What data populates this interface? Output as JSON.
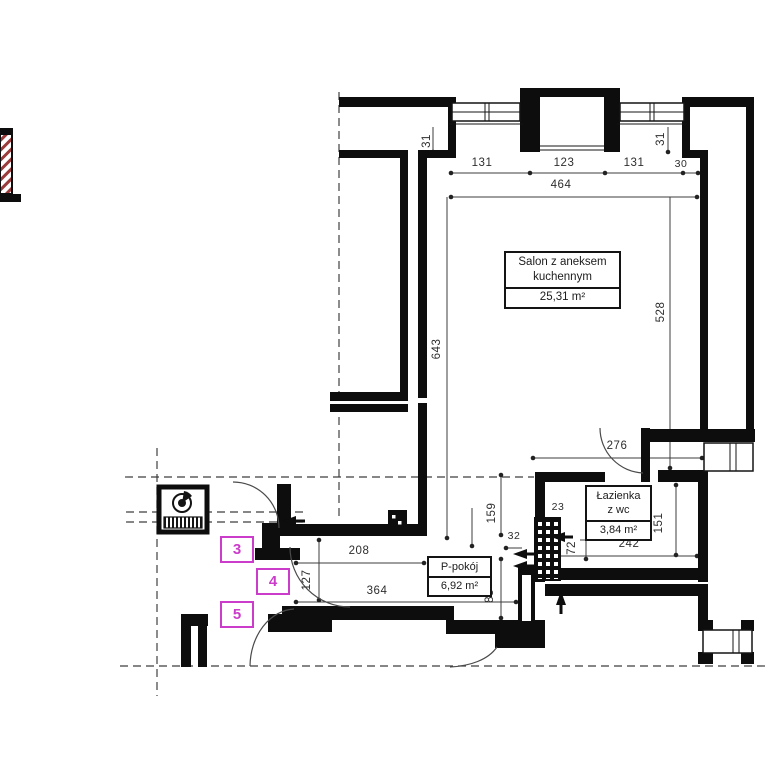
{
  "plan": {
    "rooms": {
      "salon": {
        "name_line1": "Salon z aneksem",
        "name_line2": "kuchennym",
        "area": "25,31 m²"
      },
      "bathroom": {
        "name_line1": "Łazienka",
        "name_line2": "z wc",
        "area": "3,84 m²"
      },
      "small_room": {
        "name": "P-pokój",
        "area": "6,92 m²"
      }
    },
    "markers": {
      "m3": "3",
      "m4": "4",
      "m5": "5"
    },
    "dimensions": {
      "window_left": "131",
      "balcony_niche": "123",
      "window_right": "131",
      "pier_right": "30",
      "wall_total": "464",
      "reveal_left": "31",
      "reveal_right": "31",
      "salon_depth_left": "643",
      "salon_depth_right": "528",
      "hall_width": "276",
      "hall_depth": "159",
      "shaft_top": "23",
      "shaft_left": "32",
      "shaft_height": "72",
      "bath_width": "242",
      "bath_depth": "151",
      "kitchen_opening": "208",
      "door_opening": "127",
      "room_width": "364",
      "room_edge": "83"
    },
    "colors": {
      "wall": "#0d0d0d",
      "dim_line": "#3c3c3c",
      "marker": "#cb3ccb",
      "hatch_red": "#9a3a3a"
    }
  }
}
